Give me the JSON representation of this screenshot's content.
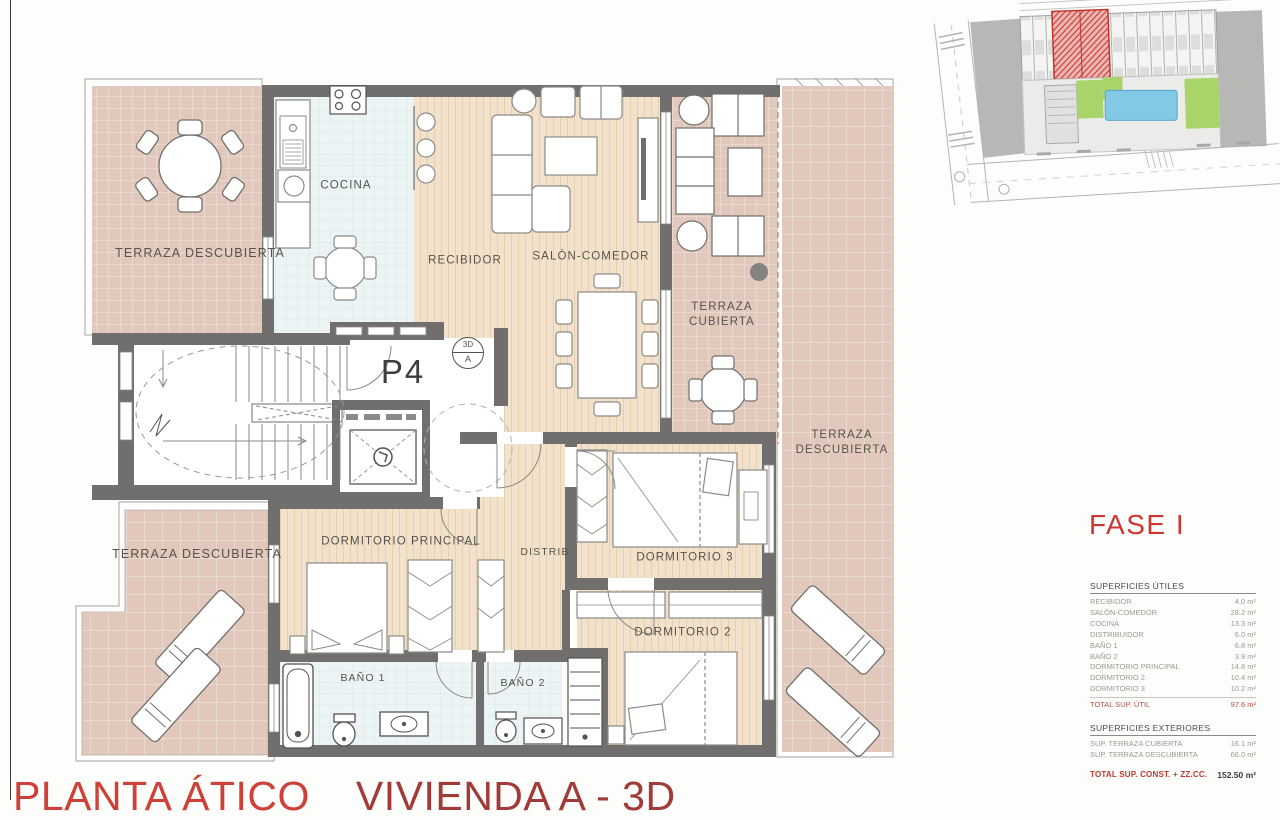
{
  "titles": {
    "plan_title": "PLANTA ÁTICO",
    "unit_title": "VIVIENDA A - 3D",
    "phase": "FASE I"
  },
  "plan": {
    "unit_number": "P4",
    "marker_3d_top": "3D",
    "marker_3d_bottom": "A",
    "rooms": {
      "terraza_descubierta_tl": "TERRAZA DESCUBIERTA",
      "cocina": "COCINA",
      "recibidor": "RECIBIDOR",
      "salon_comedor": "SALÓN-COMEDOR",
      "terraza_cubierta": "TERRAZA\nCUBIERTA",
      "terraza_descubierta_r": "TERRAZA\nDESCUBIERTA",
      "terraza_descubierta_bl": "TERRAZA DESCUBIERTA",
      "dormitorio_principal": "DORMITORIO PRINCIPAL",
      "distribuidor": "DISTRIB.",
      "dormitorio_3": "DORMITORIO 3",
      "dormitorio_2": "DORMITORIO 2",
      "bano_1": "BAÑO 1",
      "bano_2": "BAÑO 2"
    }
  },
  "surfaces": {
    "useful_title": "SUPERFICIES ÚTILES",
    "useful_rows": [
      {
        "label": "RECIBIDOR",
        "value": "4.0 m²"
      },
      {
        "label": "SALÓN-COMEDOR",
        "value": "28.2 m²"
      },
      {
        "label": "COCINA",
        "value": "13.3 m²"
      },
      {
        "label": "DISTRIBUIDOR",
        "value": "6.0 m²"
      },
      {
        "label": "BAÑO 1",
        "value": "6.8 m²"
      },
      {
        "label": "BAÑO 2",
        "value": "3.9 m²"
      },
      {
        "label": "DORMITORIO PRINCIPAL",
        "value": "14.8 m²"
      },
      {
        "label": "DORMITORIO 2",
        "value": "10.4 m²"
      },
      {
        "label": "DORMITORIO 3",
        "value": "10.2 m²"
      }
    ],
    "useful_total": {
      "label": "TOTAL SUP. ÚTIL",
      "value": "97.6 m²"
    },
    "exterior_title": "SUPERFICIES EXTERIORES",
    "exterior_rows": [
      {
        "label": "SUP. TERRAZA CUBIERTA",
        "value": "16.1 m²"
      },
      {
        "label": "SUP. TERRAZA DESCUBIERTA",
        "value": "66.0 m²"
      }
    ],
    "grand_total": {
      "label": "TOTAL SUP. CONST. + ZZ.CC.",
      "value": "152.50 m²"
    }
  },
  "colors": {
    "wall": "#706f6d",
    "terrace_tile": "#e2c8bb",
    "wood_floor": "#f3e2cb",
    "wet_tile": "#edf4f6",
    "accent_red": "#ce3633",
    "total_red": "#b4524e",
    "highlight_unit_red": "#c23330",
    "pool_blue": "#82c9e5",
    "garden_green": "#a9d469"
  }
}
